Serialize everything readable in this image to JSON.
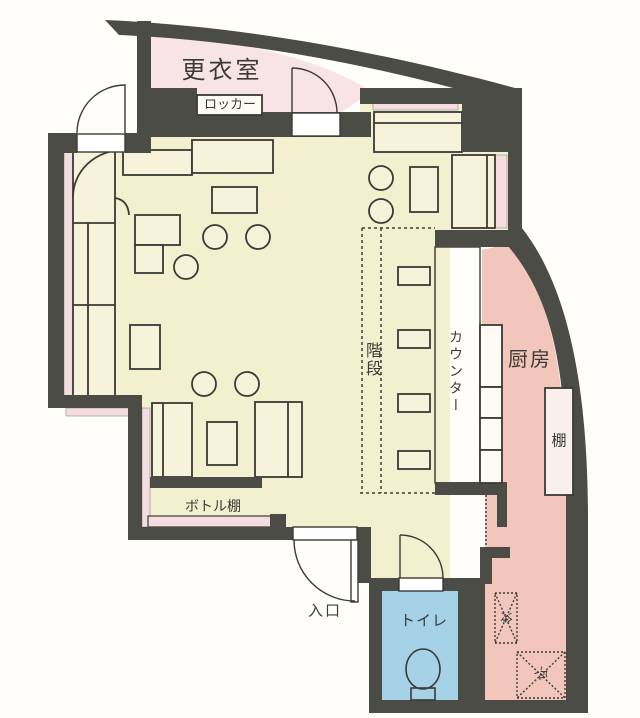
{
  "title": "店舗間取り図",
  "rooms": {
    "changing_room": "更衣室",
    "locker": "ロッカー",
    "stairs": "階段",
    "counter": "カウンター",
    "kitchen": "厨房",
    "shelf": "棚",
    "bottle_shelf": "ボトル棚",
    "entrance": "入口",
    "toilet": "トイレ",
    "fridge_1": "冷",
    "fridge_2": "冷"
  },
  "colors": {
    "wall": "#4c4c47",
    "floor": "#f3f0d0",
    "changing_room": "#f8e3e6",
    "counter": "#f8dcd5",
    "kitchen": "#f2c6ba",
    "toilet": "#a6d2e7",
    "furniture": "#f6f3da",
    "strip": "#f4dde0",
    "fixture_white": "#fdfbf4"
  }
}
